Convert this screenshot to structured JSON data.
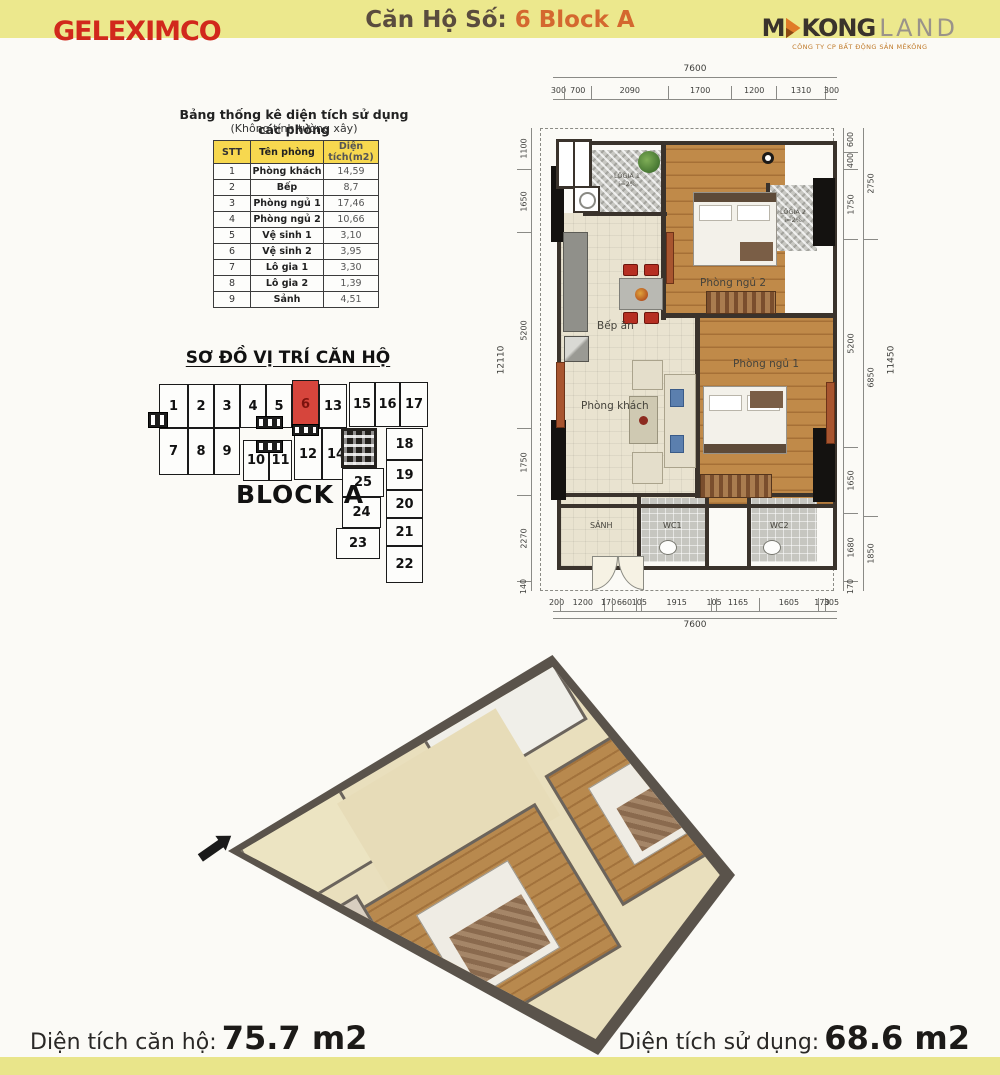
{
  "colors": {
    "band_yellow": "#ece88d",
    "brand_red": "#d1281c",
    "accent_orange": "#d4682f",
    "table_header_yellow": "#f7d84f",
    "highlight_unit_red": "#d6453c",
    "wall_dark": "#3a332c",
    "wood_floor": "#c08a49"
  },
  "header": {
    "brand": "GELEXIMCO",
    "title_prefix": "Căn Hộ Số:",
    "title_highlight": "6 Block A",
    "mekong_m": "M",
    "mekong_kong": "KONG",
    "mekong_land": "LAND",
    "mekong_subtitle": "CÔNG TY CP BẤT ĐỘNG SẢN MÊKÔNG"
  },
  "area_table": {
    "title": "Bảng thống kê diện tích sử dụng các phòng",
    "subtitle": "(Không tính tường xây)",
    "columns": [
      "STT",
      "Tên phòng",
      "Diện tích(m2)"
    ],
    "rows": [
      [
        "1",
        "Phòng khách",
        "14,59"
      ],
      [
        "2",
        "Bếp",
        "8,7"
      ],
      [
        "3",
        "Phòng ngủ 1",
        "17,46"
      ],
      [
        "4",
        "Phòng ngủ 2",
        "10,66"
      ],
      [
        "5",
        "Vệ sinh 1",
        "3,10"
      ],
      [
        "6",
        "Vệ sinh 2",
        "3,95"
      ],
      [
        "7",
        "Lô gia 1",
        "3,30"
      ],
      [
        "8",
        "Lô gia 2",
        "1,39"
      ],
      [
        "9",
        "Sảnh",
        "4,51"
      ]
    ]
  },
  "location_diagram": {
    "title": "SƠ ĐỒ VỊ TRÍ CĂN HỘ",
    "block_label": "BLOCK A",
    "highlighted_unit": "6",
    "units": [
      {
        "label": "1",
        "x": 159,
        "y": 384,
        "w": 29,
        "h": 44
      },
      {
        "label": "2",
        "x": 188,
        "y": 384,
        "w": 26,
        "h": 44
      },
      {
        "label": "3",
        "x": 214,
        "y": 384,
        "w": 26,
        "h": 44
      },
      {
        "label": "4",
        "x": 240,
        "y": 384,
        "w": 26,
        "h": 44
      },
      {
        "label": "5",
        "x": 266,
        "y": 384,
        "w": 26,
        "h": 44
      },
      {
        "label": "6",
        "x": 292,
        "y": 380,
        "w": 27,
        "h": 48,
        "highlighted": true
      },
      {
        "label": "13",
        "x": 319,
        "y": 384,
        "w": 28,
        "h": 44
      },
      {
        "label": "15",
        "x": 349,
        "y": 382,
        "w": 26,
        "h": 45
      },
      {
        "label": "16",
        "x": 375,
        "y": 382,
        "w": 25,
        "h": 45
      },
      {
        "label": "17",
        "x": 400,
        "y": 382,
        "w": 28,
        "h": 45
      },
      {
        "label": "7",
        "x": 159,
        "y": 428,
        "w": 29,
        "h": 47
      },
      {
        "label": "8",
        "x": 188,
        "y": 428,
        "w": 26,
        "h": 47
      },
      {
        "label": "9",
        "x": 214,
        "y": 428,
        "w": 26,
        "h": 47
      },
      {
        "label": "10",
        "x": 243,
        "y": 440,
        "w": 26,
        "h": 41
      },
      {
        "label": "11",
        "x": 269,
        "y": 440,
        "w": 23,
        "h": 41
      },
      {
        "label": "12",
        "x": 294,
        "y": 428,
        "w": 28,
        "h": 52
      },
      {
        "label": "14",
        "x": 322,
        "y": 428,
        "w": 28,
        "h": 52
      },
      {
        "label": "18",
        "x": 386,
        "y": 428,
        "w": 37,
        "h": 32
      },
      {
        "label": "19",
        "x": 386,
        "y": 460,
        "w": 37,
        "h": 30
      },
      {
        "label": "20",
        "x": 386,
        "y": 490,
        "w": 37,
        "h": 28
      },
      {
        "label": "21",
        "x": 386,
        "y": 518,
        "w": 37,
        "h": 28
      },
      {
        "label": "22",
        "x": 386,
        "y": 546,
        "w": 37,
        "h": 37
      },
      {
        "label": "25",
        "x": 342,
        "y": 468,
        "w": 42,
        "h": 29
      },
      {
        "label": "24",
        "x": 342,
        "y": 497,
        "w": 39,
        "h": 31
      },
      {
        "label": "23",
        "x": 336,
        "y": 528,
        "w": 44,
        "h": 31
      }
    ]
  },
  "floor_plan": {
    "rooms": {
      "logia1": "LÔGIA 1",
      "logia1_slope": "i=2%",
      "bedroom2": "Phòng ngủ 2",
      "logia2": "LÔGIA 2",
      "logia2_slope": "i=2%",
      "kitchen": "Bếp ăn",
      "living": "Phòng khách",
      "bedroom1": "Phòng ngủ 1",
      "hall": "SẢNH",
      "wc1": "WC1",
      "wc2": "WC2"
    },
    "dims": {
      "top_total": "7600",
      "top": [
        "300",
        "700",
        "2090",
        "1700",
        "1200",
        "1310",
        "300"
      ],
      "bottom": [
        "200",
        "1200",
        "170",
        "660",
        "105",
        "1915",
        "105",
        "1165",
        "1605",
        "170",
        "305"
      ],
      "bottom_total": "7600",
      "left": [
        "1100",
        "1650",
        "5200",
        "1750",
        "2270",
        "140"
      ],
      "left_total": "12110",
      "right_inner": [
        "600",
        "400",
        "1750",
        "5200",
        "1650",
        "1680",
        "170"
      ],
      "right_mid": [
        "2750",
        "6850",
        "1850"
      ],
      "right_total": "11450"
    }
  },
  "footer": {
    "left_label": "Diện tích căn hộ:",
    "left_value": "75.7 m2",
    "right_label": "Diện tích sử dụng:",
    "right_value": "68.6 m2"
  }
}
